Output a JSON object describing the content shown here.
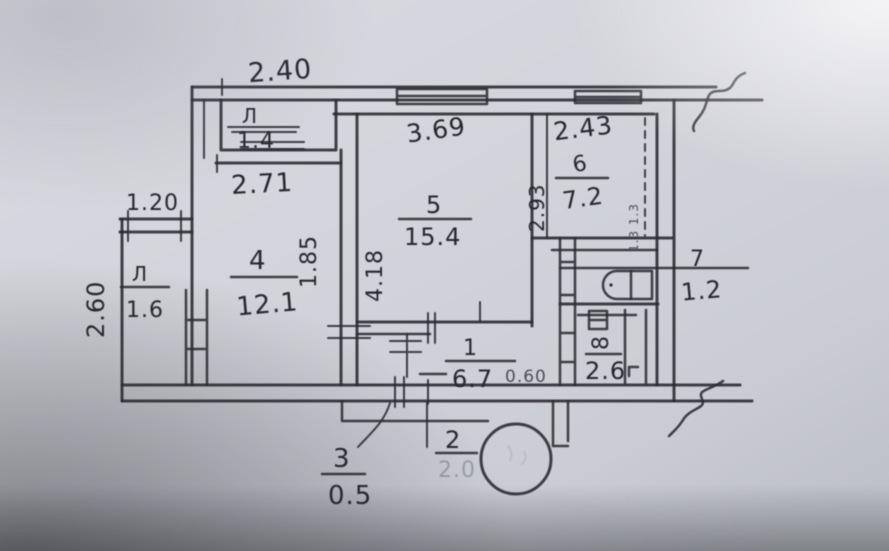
{
  "plan": {
    "rooms": {
      "loggia_top": {
        "number": "Л",
        "area": "1.4"
      },
      "room4": {
        "number": "4",
        "area": "12.1"
      },
      "room5": {
        "number": "5",
        "area": "15.4"
      },
      "kitchen6": {
        "number": "6",
        "area": "7.2"
      },
      "wc7": {
        "number": "7",
        "area": "1.2"
      },
      "bath8": {
        "number": "8",
        "area": "2.6"
      },
      "hall1": {
        "number": "1",
        "area": "6.7"
      },
      "closet2": {
        "number": "2",
        "area": "2.0"
      },
      "closet3": {
        "number": "3",
        "area": "0.5"
      },
      "loggia_left": {
        "number": "Л",
        "area": "1.6"
      }
    },
    "dims": {
      "top_width": "2.40",
      "room4_width": "2.71",
      "room5_width": "3.69",
      "kitchen_width": "2.43",
      "kitchen_depth": "2.93",
      "room5_depth": "4.18",
      "room4_side": "1.85",
      "loggia_width": "1.20",
      "loggia_depth": "2.60",
      "hall_note": "0.60",
      "shaft_note": "1.3 1.3"
    },
    "colors": {
      "paper": "#d6d7de",
      "ink": "#2a2b31"
    }
  }
}
